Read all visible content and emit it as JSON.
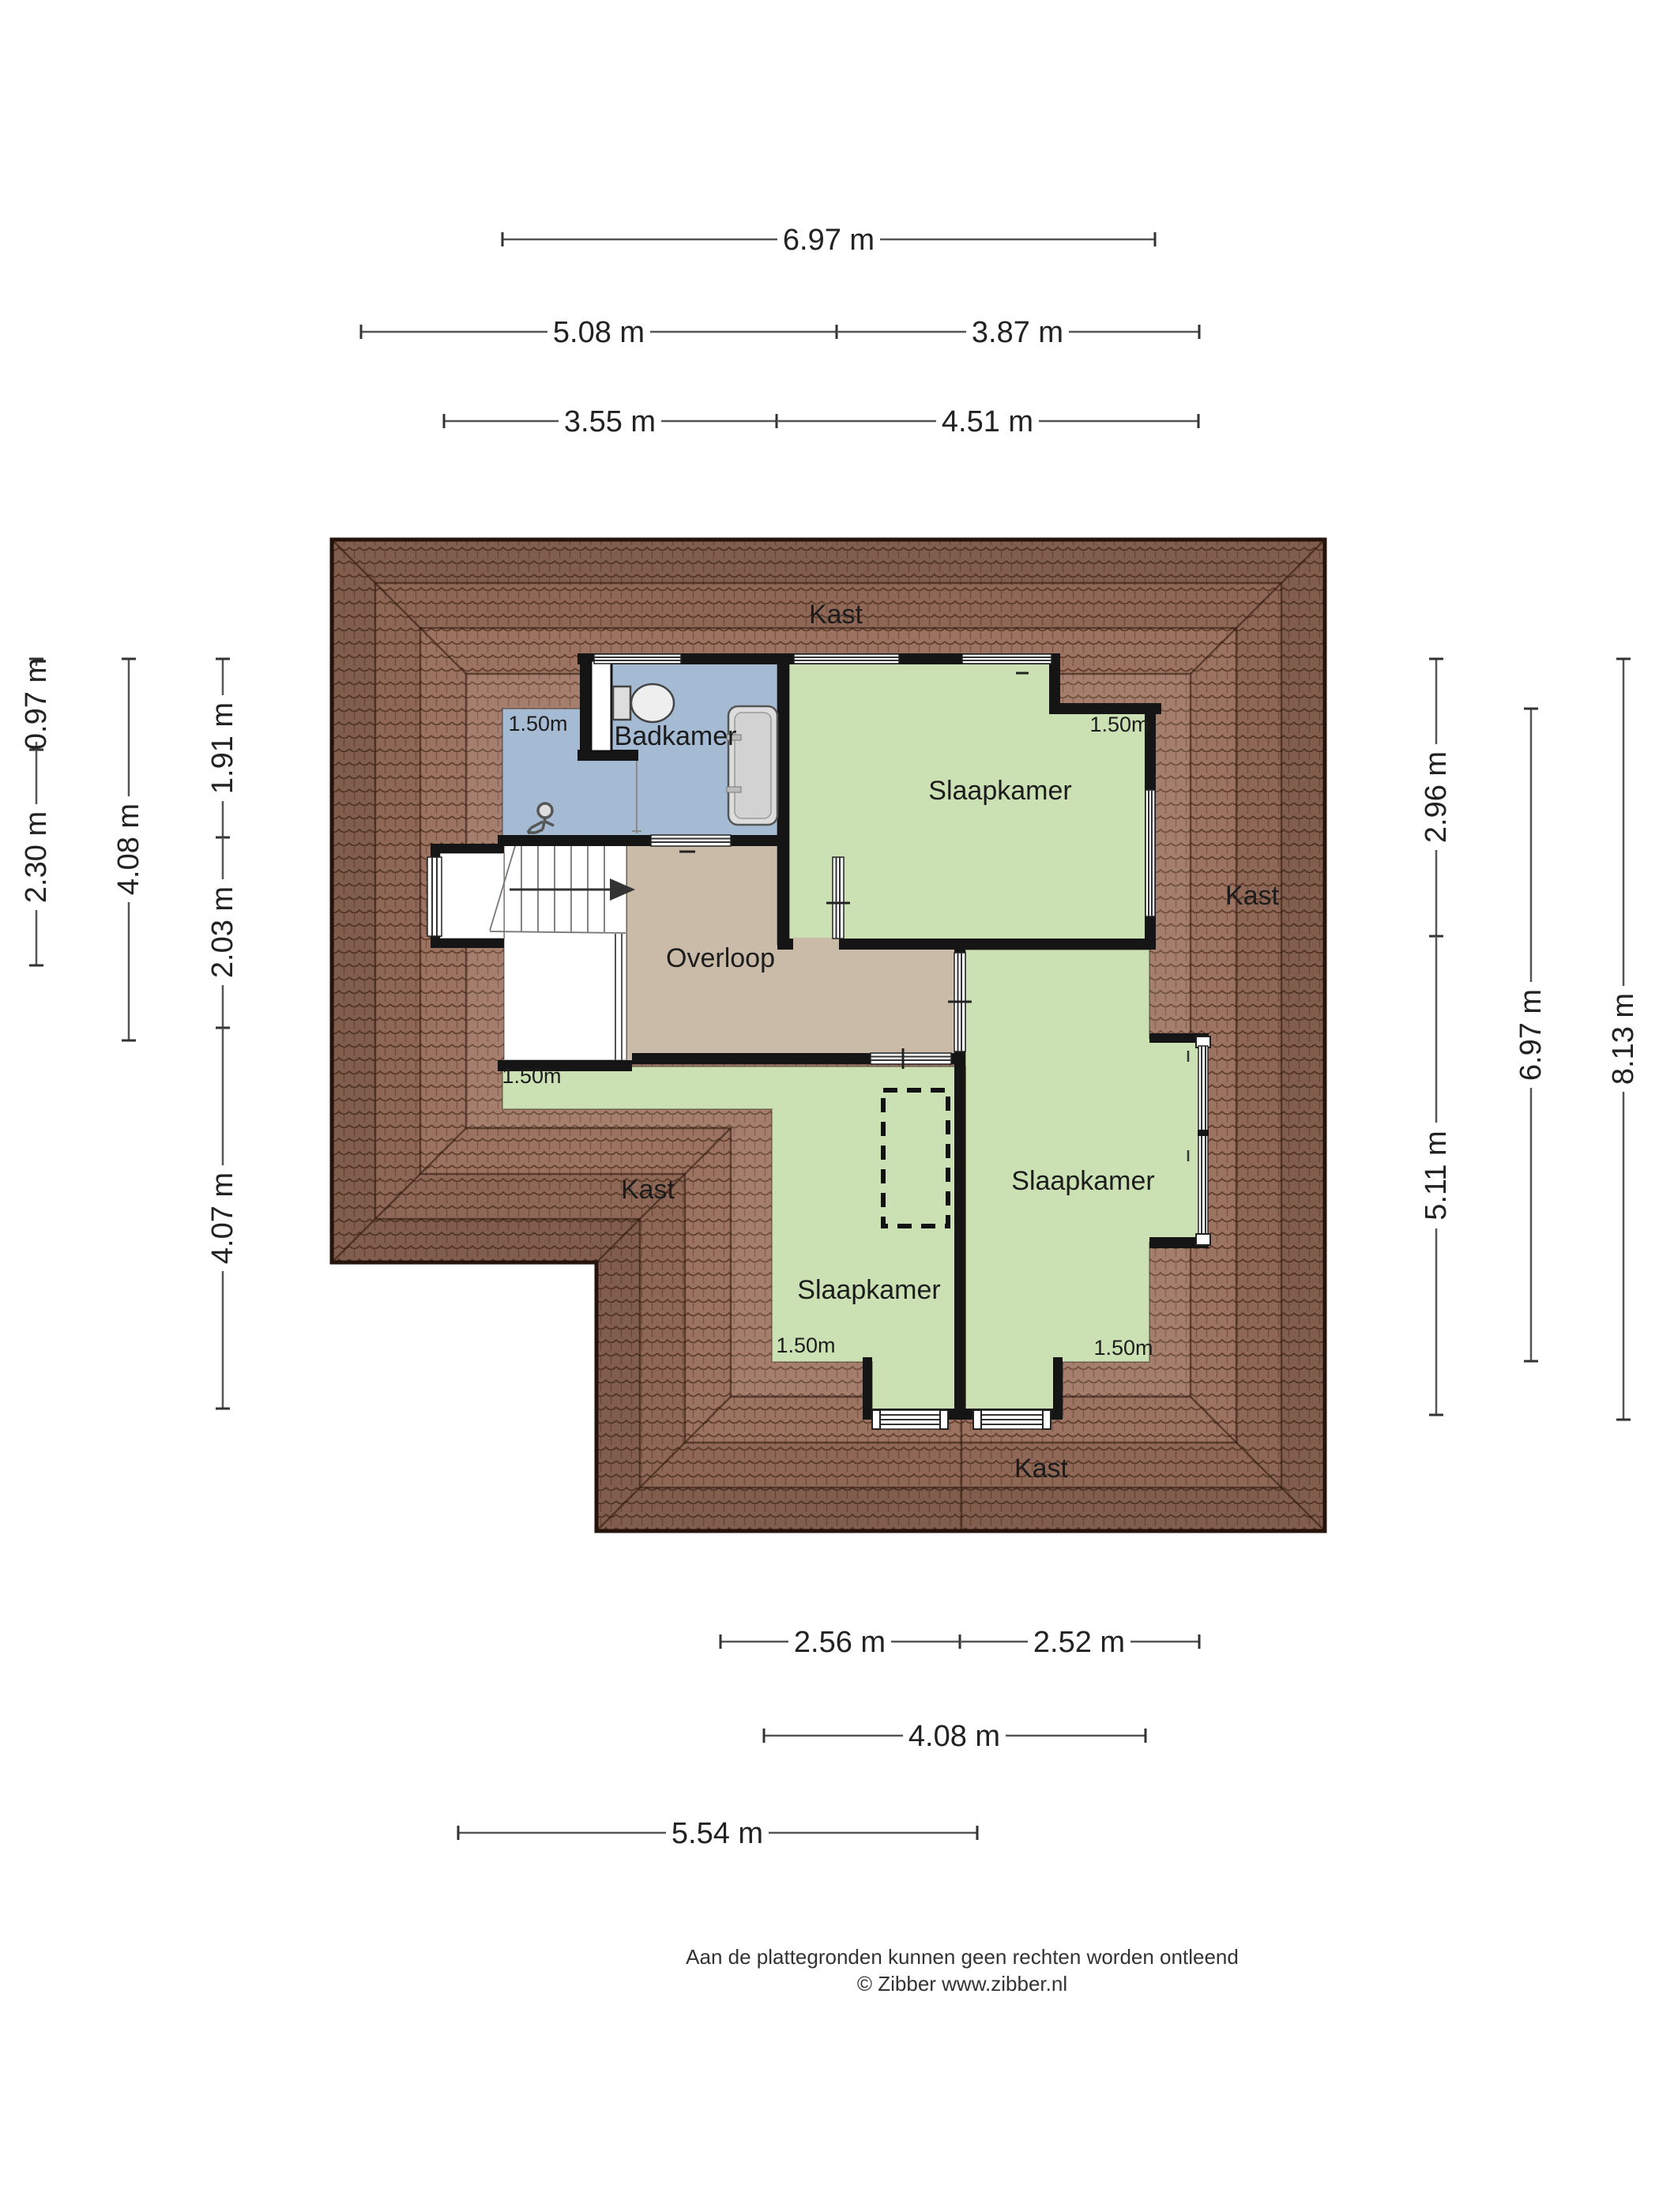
{
  "plan": {
    "room_labels": {
      "bathroom": "Badkamer",
      "landing": "Overloop",
      "bedroom": "Slaapkamer"
    },
    "storage_label": "Kast",
    "ceiling_height_marker": "1.50m",
    "colors": {
      "roof_tile": "#9c7260",
      "roof_edge": "#26150d",
      "bedroom_green": "#cbe1b3",
      "bathroom_blue": "#a5bad3",
      "landing_tan": "#c9bba8",
      "wall_black": "#151515",
      "dimension_line": "#555555",
      "dimension_text": "#222222"
    }
  },
  "dimensions": {
    "top": {
      "total": "6.97 m",
      "row2_left": "5.08 m",
      "row2_right": "3.87 m",
      "row3_left": "3.55 m",
      "row3_right": "4.51 m"
    },
    "left": {
      "a": "0.97 m",
      "b": "2.30 m",
      "c": "4.08 m",
      "d": "1.91 m",
      "e": "2.03 m",
      "f": "4.07 m"
    },
    "right": {
      "a": "2.96 m",
      "b": "5.11 m",
      "c": "6.97 m",
      "d": "8.13 m"
    },
    "bottom": {
      "a": "2.56 m",
      "b": "2.52 m",
      "c": "4.08 m",
      "d": "5.54 m"
    }
  },
  "footer": {
    "disclaimer": "Aan de plattegronden kunnen geen rechten worden ontleend",
    "credit": "© Zibber www.zibber.nl"
  }
}
